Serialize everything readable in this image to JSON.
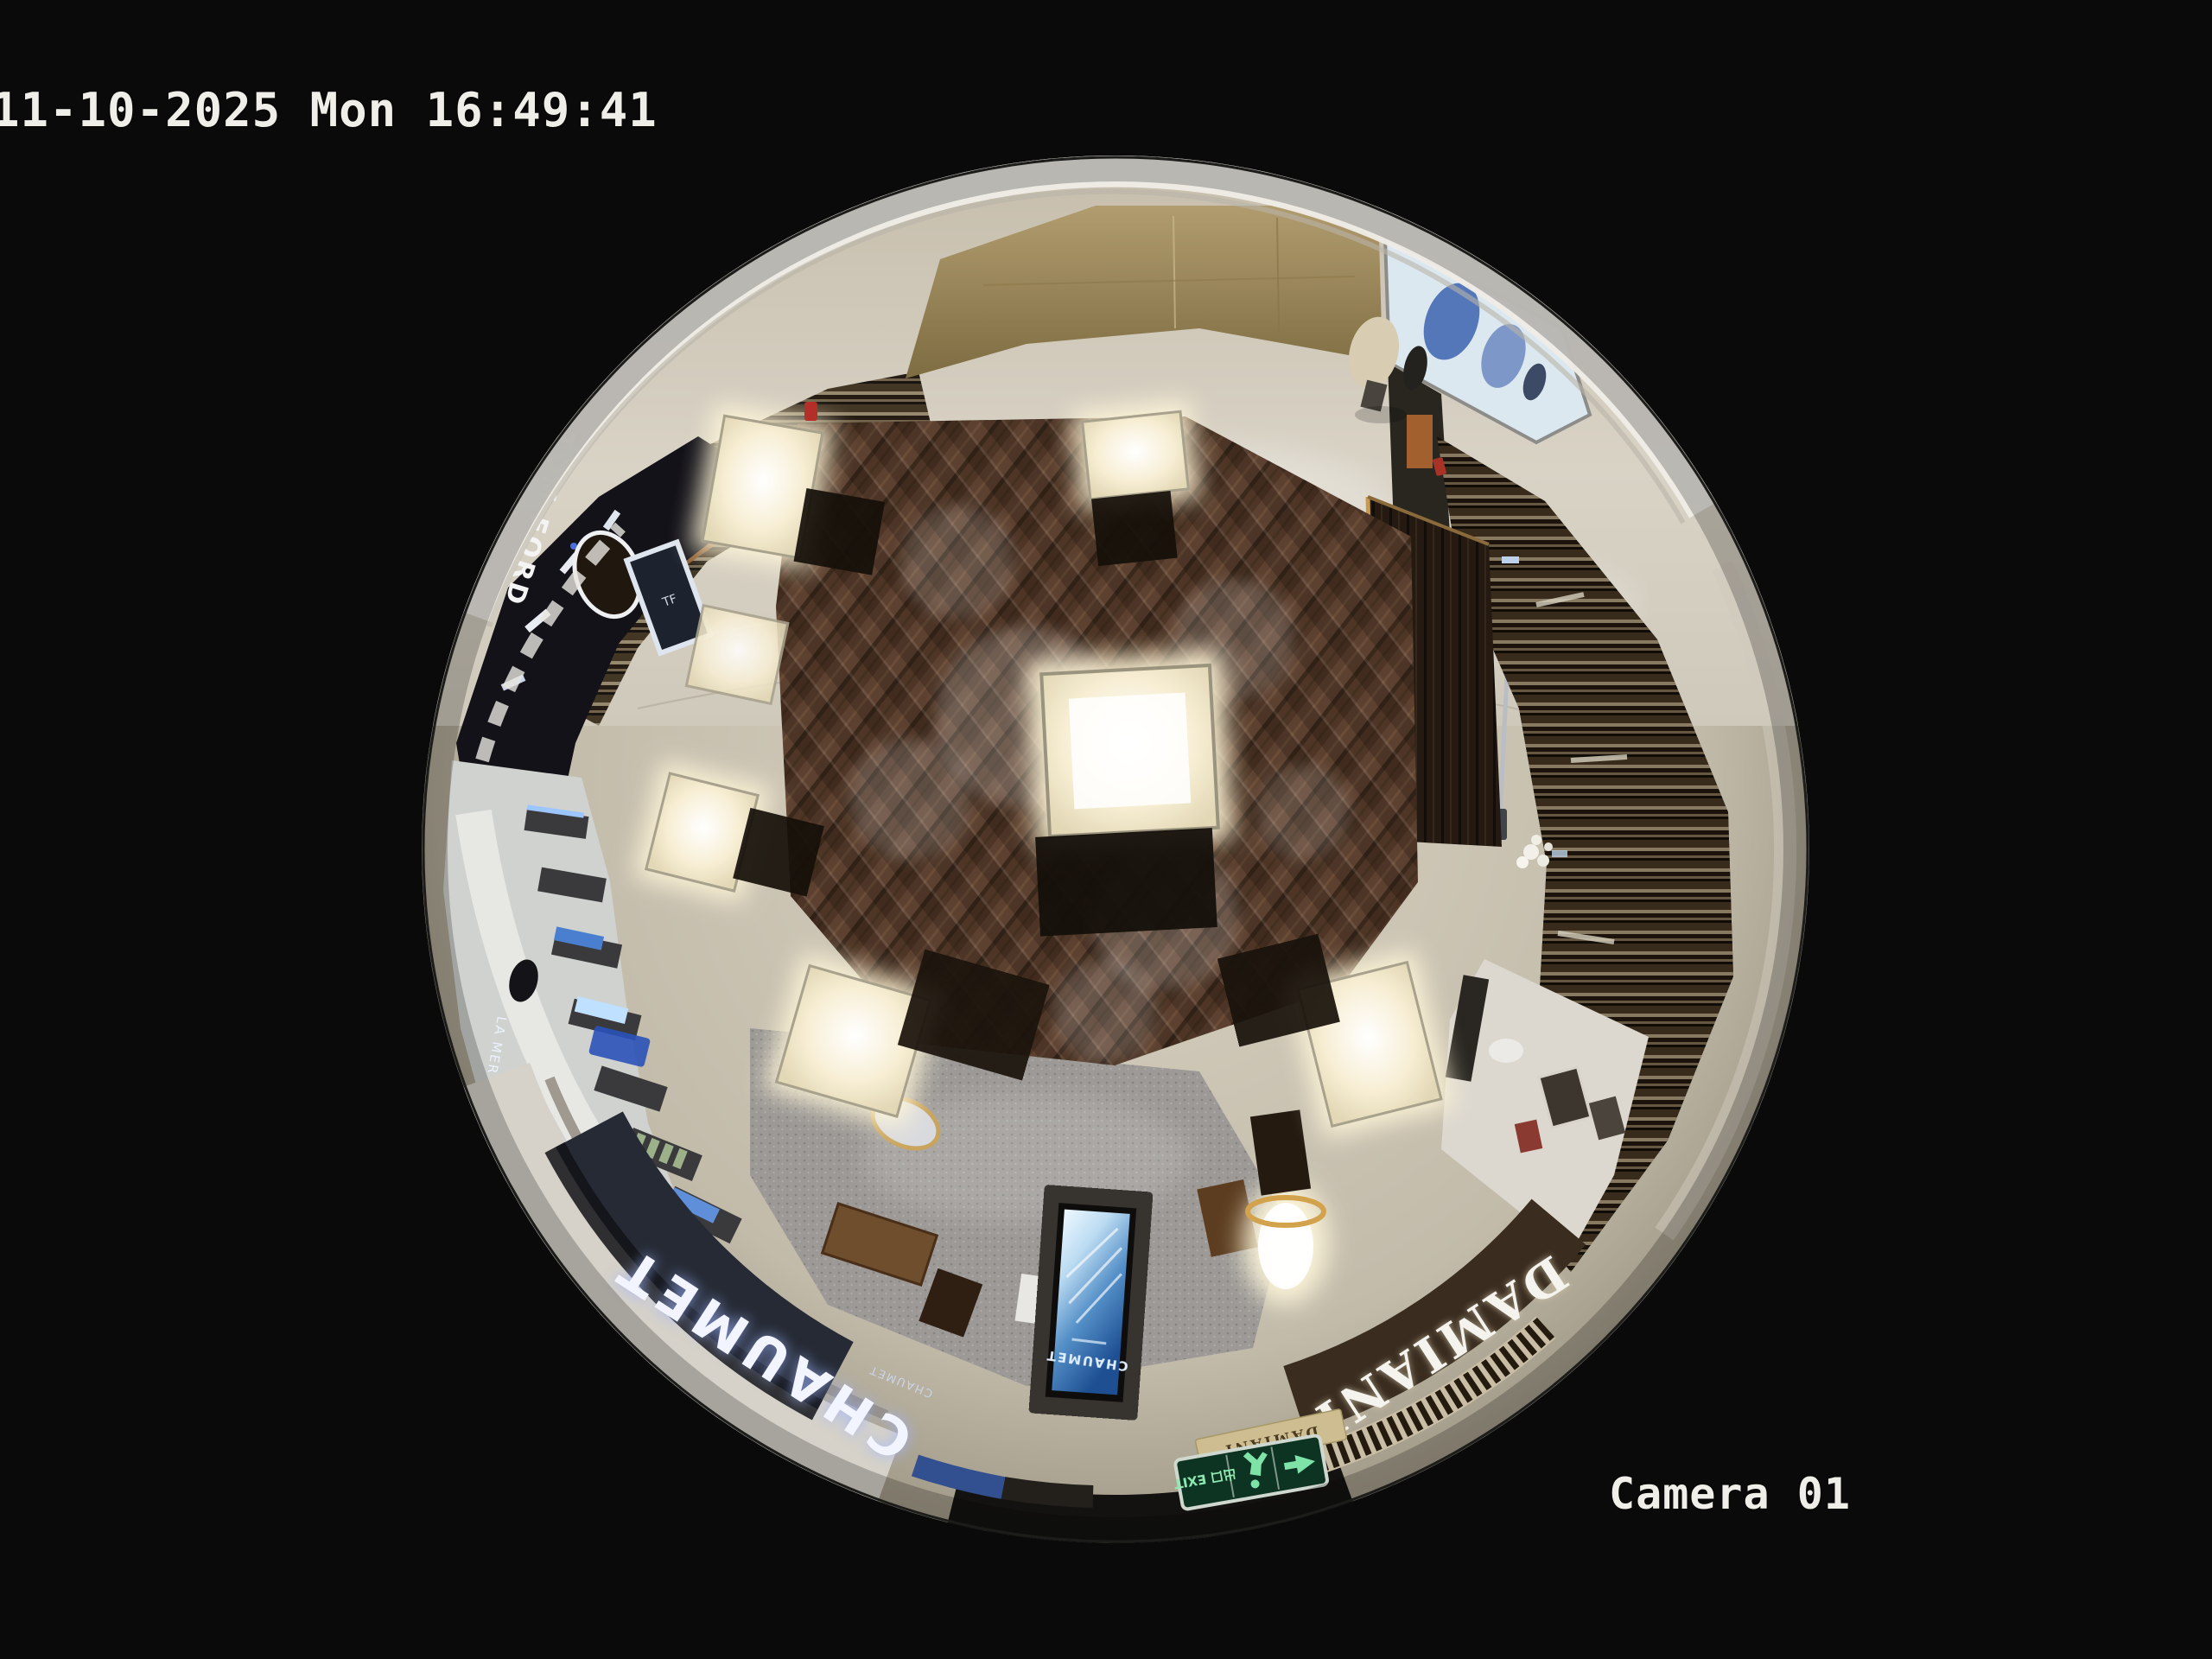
{
  "osd": {
    "timestamp": "11-10-2025 Mon 16:49:41",
    "camera_label": "Camera 01"
  },
  "scene": {
    "signs": {
      "chaumet_fascia": "CHAUMET",
      "chaumet_fascia_small": "CHAUMET",
      "damiani_fascia": "DAMIANI",
      "damiani_entry_band": "DAMIANI",
      "tom_ford_storefront": "TOM FORD",
      "tom_ford_logo": "TF",
      "kiosk_screen_brand": "CHAUMET",
      "lamer_counter_sign": "LA MER",
      "exit_sign": "出口 EXIT"
    },
    "colors": {
      "background": "#0a0a0a",
      "osd_text": "#f0eee9",
      "wood_floor": "#4e3625",
      "marble_floor": "#cfc8b8",
      "chaumet_fascia_bg": "#252a34",
      "damiani_fascia_bg": "#3a2d20",
      "exit_sign_green": "#0d3322",
      "kiosk_screen_blue": "#1d4f92",
      "case_glow": "#fdf5da",
      "gold_wall": "#a8946a"
    }
  }
}
